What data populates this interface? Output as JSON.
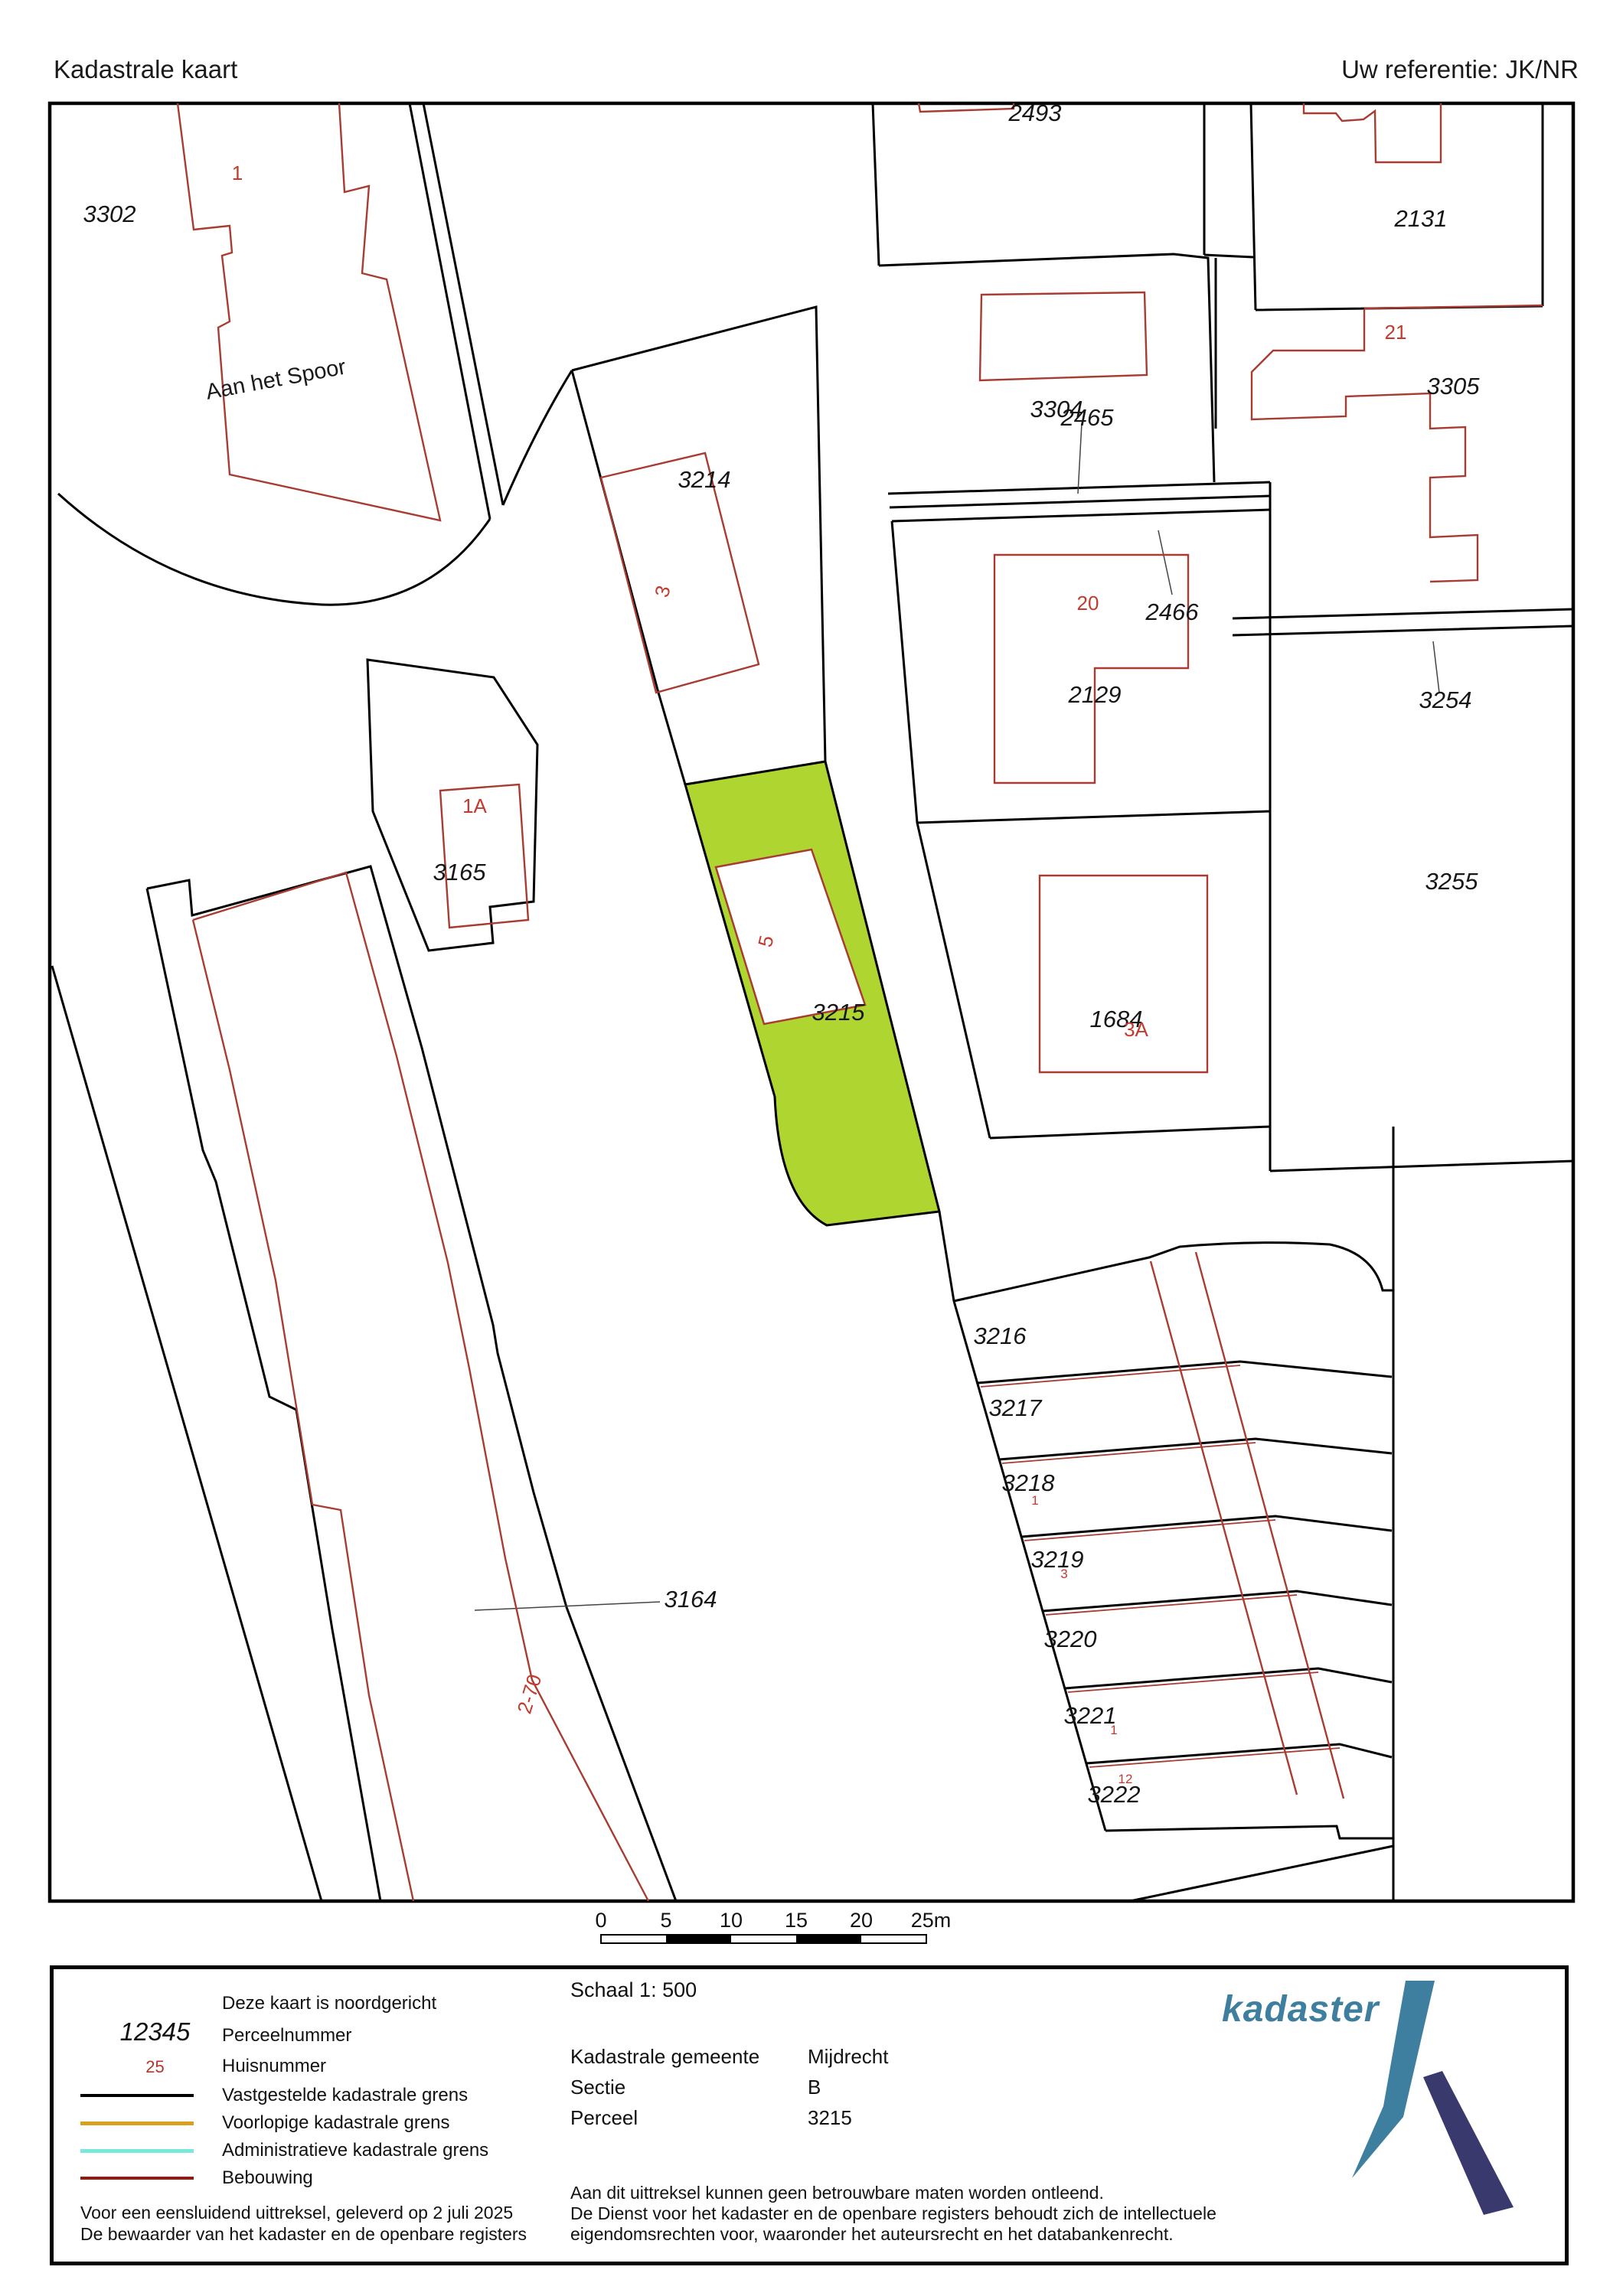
{
  "header": {
    "title": "Kadastrale kaart",
    "reference": "Uw referentie: JK/NR"
  },
  "map": {
    "street": "Aan het Spoor",
    "labels": [
      "3302",
      "2493",
      "2131",
      "3304",
      "2465",
      "3305",
      "2466",
      "2129",
      "3254",
      "3255",
      "3214",
      "3165",
      "3215",
      "1684",
      "3164",
      "3216",
      "3217",
      "3218",
      "3219",
      "3220",
      "3221",
      "3222"
    ],
    "red_labels": [
      "1",
      "21",
      "20",
      "1A",
      "5",
      "3A",
      "2-70",
      "1",
      "3",
      "1",
      "12"
    ]
  },
  "scalebar": {
    "ticks": [
      "0",
      "5",
      "10",
      "15",
      "20",
      "25m"
    ]
  },
  "legend": {
    "north_note": "Deze kaart is noordgericht",
    "items": [
      {
        "symbol": "12345",
        "label": "Perceelnummer"
      },
      {
        "symbol": "25",
        "label": "Huisnummer"
      },
      {
        "symbol": "line-black",
        "label": "Vastgestelde kadastrale grens"
      },
      {
        "symbol": "line-orange",
        "label": "Voorlopige kadastrale grens"
      },
      {
        "symbol": "line-cyan",
        "label": "Administratieve kadastrale grens"
      },
      {
        "symbol": "line-darkred",
        "label": "Bebouwing"
      }
    ],
    "issue_line1": "Voor een eensluidend uittreksel, geleverd op 2 juli 2025",
    "issue_line2": "De bewaarder van het kadaster en de openbare registers"
  },
  "details": {
    "scale_label": "Schaal 1: 500",
    "rows": [
      {
        "label": "Kadastrale gemeente",
        "value": "Mijdrecht"
      },
      {
        "label": "Sectie",
        "value": "B"
      },
      {
        "label": "Perceel",
        "value": "3215"
      }
    ],
    "disclaimer1": "Aan dit uittreksel kunnen geen betrouwbare maten worden ontleend.",
    "disclaimer2": "De Dienst voor het kadaster en de openbare registers behoudt zich de intellectuele",
    "disclaimer3": "eigendomsrechten voor, waaronder het auteursrecht en het databankenrecht."
  },
  "logo": {
    "wordmark": "kadaster"
  },
  "colors": {
    "highlight_parcel": "#afd630",
    "building_line": "#a93c32",
    "boundary_line": "#000000",
    "provisional_boundary": "#d7a021",
    "administrative_boundary": "#7ce8d9",
    "bebouwing_legend": "#8b1d15",
    "logo_teal": "#3e7e9e",
    "logo_navy": "#39396e"
  }
}
